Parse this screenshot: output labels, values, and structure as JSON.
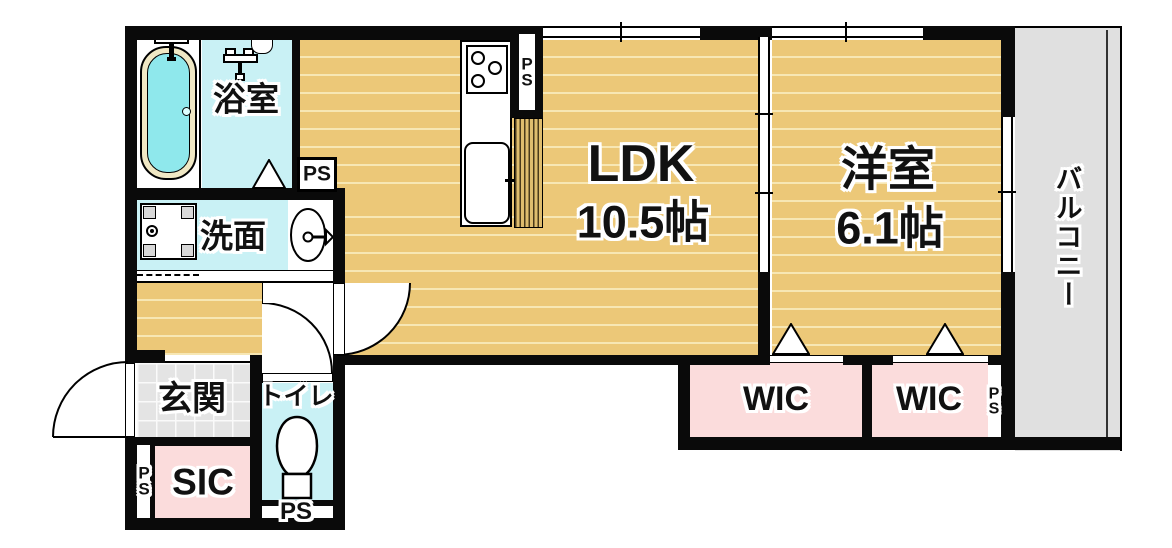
{
  "plan_type": "apartment-floor-plan",
  "rooms": {
    "ldk": {
      "label": "LDK",
      "size": "10.5帖"
    },
    "western_room": {
      "label": "洋室",
      "size": "6.1帖"
    },
    "bathroom": {
      "label": "浴室"
    },
    "washroom": {
      "label": "洗面"
    },
    "entrance": {
      "label": "玄関"
    },
    "toilet": {
      "label": "トイレ"
    },
    "shoe_closet": {
      "label": "SIC"
    },
    "walk_in_closet_left": {
      "label": "WIC"
    },
    "walk_in_closet_right": {
      "label": "WIC"
    },
    "balcony": {
      "label": "バルコニー"
    }
  },
  "pipe_spaces": {
    "bathroom_side": "PS",
    "kitchen_side": "PS",
    "entrance_side": "PS",
    "toilet_bottom": "PS",
    "closet_side": "PS"
  },
  "colors": {
    "wall": "#0a0a0a",
    "wood_floor": "#ecc878",
    "wood_plank_line": "#f7e7b4",
    "wet_area_floor": "#c9f1f5",
    "tub_water": "#8fe8ec",
    "tub_rim": "#f0e8c4",
    "closet_pink": "#fbdcdc",
    "entrance_tile": "#e4e4e4",
    "balcony_gray": "#e0e0e0"
  }
}
